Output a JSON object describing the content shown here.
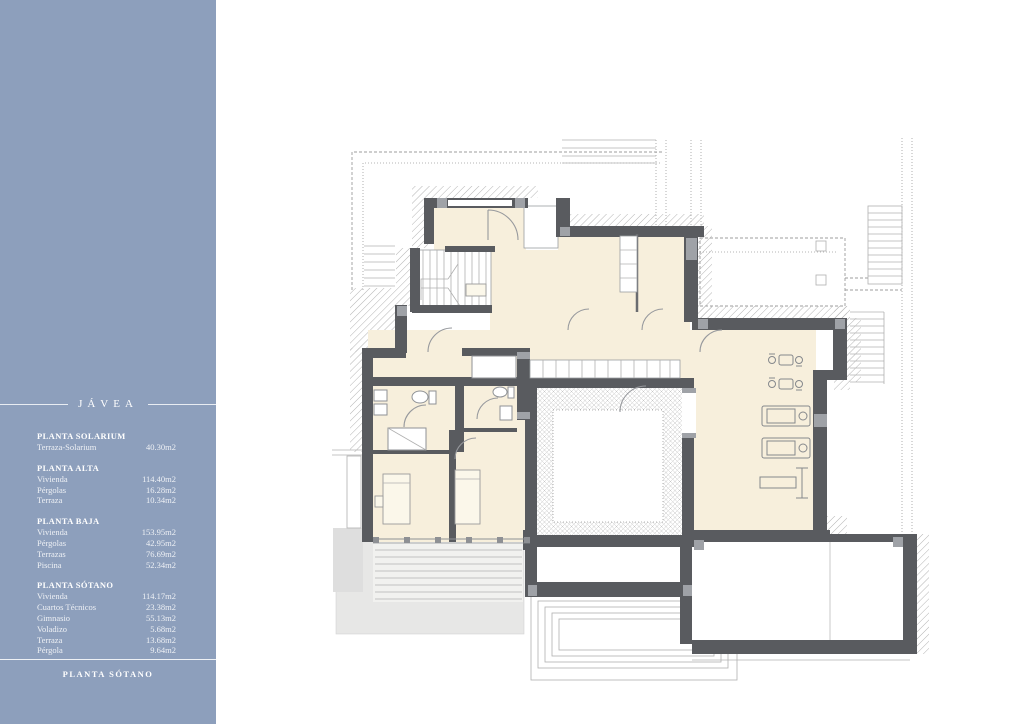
{
  "sidebar": {
    "title": "JÁVEA",
    "sections": [
      {
        "header": "PLANTA SOLARIUM",
        "rows": [
          {
            "label": "Terraza-Solarium",
            "value": "40.30m2"
          }
        ]
      },
      {
        "header": "PLANTA ALTA",
        "rows": [
          {
            "label": "Vivienda",
            "value": "114.40m2"
          },
          {
            "label": "Pérgolas",
            "value": "16.28m2"
          },
          {
            "label": "Terraza",
            "value": "10.34m2"
          }
        ]
      },
      {
        "header": "PLANTA BAJA",
        "rows": [
          {
            "label": "Vivienda",
            "value": "153.95m2"
          },
          {
            "label": "Pérgolas",
            "value": "42.95m2"
          },
          {
            "label": "Terrazas",
            "value": "76.69m2"
          },
          {
            "label": "Piscina",
            "value": "52.34m2"
          }
        ]
      },
      {
        "header": "PLANTA SÓTANO",
        "rows": [
          {
            "label": "Vivienda",
            "value": "114.17m2"
          },
          {
            "label": "Cuartos Técnicos",
            "value": "23.38m2"
          },
          {
            "label": "Gimnasio",
            "value": "55.13m2"
          },
          {
            "label": "Voladizo",
            "value": "5.68m2"
          },
          {
            "label": "Terraza",
            "value": "13.68m2"
          },
          {
            "label": "Pérgola",
            "value": "9.64m2"
          }
        ]
      }
    ],
    "footer": "PLANTA SÓTANO"
  },
  "plan": {
    "type": "architectural-floor-plan",
    "elements": [
      "staircase",
      "bedrooms",
      "bathrooms",
      "corridor-closets",
      "central-courtyard",
      "gymnasium",
      "gym-equipment",
      "wood-deck-terrace",
      "pool-steps",
      "exterior-stairs"
    ]
  },
  "theme": {
    "sidebar_bg": "#8d9fbc",
    "sidebar_text": "#ffffff",
    "wall": "#595b5f",
    "cream": "#f7efdc",
    "lintel": "#9fa2a7",
    "line": "#9a9da1",
    "dash": "#9c9c9c",
    "terrace": "#e7e7e6",
    "deck": "#f1f1ef"
  }
}
